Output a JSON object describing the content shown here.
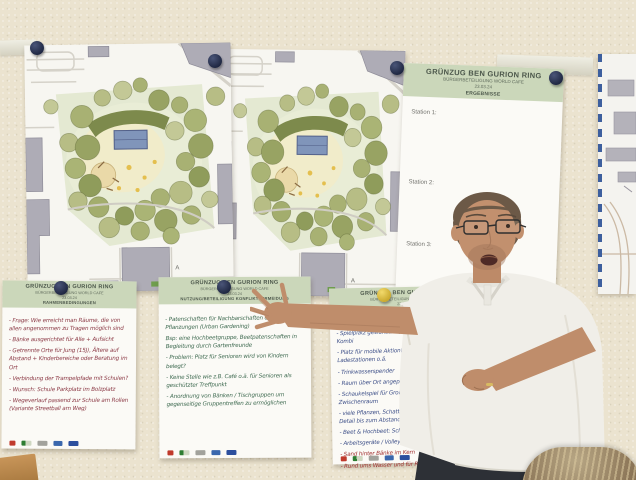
{
  "photo": {
    "description": "Presenter in a white polo shirt pointing at handwritten workshop flip charts pinned on a cream wall, beside two park landscape plans and a results poster",
    "setting": "citizen participation workshop wall"
  },
  "colors": {
    "wall": "#ebe3cf",
    "header_green": "#cbd7ba",
    "pin_navy": "#2a3150",
    "pin_yellow": "#ddc13f",
    "ink_dark_red": "#8c3a46",
    "ink_green": "#3e6a50",
    "ink_blue": "#3d4f88",
    "ink_red": "#a23333",
    "plan_lawn": "#e4e9d2",
    "plan_tree": "#a8b173",
    "map_border_blue": "#3d5f9e"
  },
  "plans": {
    "marker": "A"
  },
  "results_poster": {
    "title": "GRÜNZUG BEN GURION RING",
    "subtitle": "BÜRGERBETEILIGUNG WORLD CAFE",
    "date": "23.03.24",
    "section": "ERGEBNISSE",
    "stations": [
      "Station 1:",
      "Station 2:",
      "Station 3:"
    ]
  },
  "flipcharts": [
    {
      "title": "GRÜNZUG BEN GURION RING",
      "subtitle": "BÜRGERBETEILIGUNG WORLD CAFE",
      "date": "23.03.24",
      "section": "RAHMENBEDINGUNGEN",
      "notes": [
        "- Frage: Wie erreicht man Räume, die von allen angenommen zu Tragen möglich sind",
        "- Bänke ausgerichtet für Alle + Aufsicht",
        "- Getrennte Orte für Jung (15J), Ältere auf Abstand + Kinderbereiche oder Beratung im Ort",
        "- Verbindung der Trampelpfade mit Schulen?",
        "- Wunsch: Schule Parkplatz im Bolzplatz",
        "- Wegeverlauf passend zur Schule am Rollen (Variante Streetball am Weg)"
      ]
    },
    {
      "title": "GRÜNZUG BEN GURION RING",
      "subtitle": "BÜRGERBETEILIGUNG WORLD CAFE",
      "date": "23.03.24",
      "section": "NUTZUNG/BETEILIGUNG KONFLIKTVERMEIDUNG",
      "notes": [
        "- Patenschaften für Nachbarschaften oder Pflege für Pflanzungen (Urban Gardening)",
        "  Bsp: eine Hochbeetgruppe, Beetpatenschaften in Begleitung durch Gartenfreunde",
        "- Problem: Platz für Senioren wird von Kindern belegt?",
        "- Keine Stelle wie z.B. Café o.ä. für Senioren als geschützter Treffpunkt",
        "- Anordnung von Bänken / Tischgruppen um gegenseitige Gruppentreffen zu ermöglichen"
      ]
    },
    {
      "title": "GRÜNZUG BEN GURION RING",
      "subtitle": "BÜRGERBETEILIGUNG WORLD CAFE",
      "date": "23.03.24",
      "section": "",
      "notes": [
        "- Sp.",
        "- Spielplatz gewünscht (Wasserspiel?) : Bank-Tisch-Kombi",
        "- Platz für mobile Aktion! angepasst 4 Ladestationen o.ä.",
        "- Trinkwasserspender",
        "- Raum über Ort angepasst",
        "- Schaukelspiel für Groß & Klein: Rutsche + Zwischenraum",
        "- viele Pflanzen, Schatten / Obstbäume z.B. d.L. im Detail bis zum Abstand",
        "- Beet & Hochbeet: Schilder zum Beschriften",
        "- Arbeitsgeräte / Volleyballfeld? im Blick zum Nutzen"
      ],
      "notes_red": [
        "- Sand hinter Bänke im Kern",
        "- Rund ums Wasser und für Radeln: Aktiv"
      ]
    }
  ]
}
